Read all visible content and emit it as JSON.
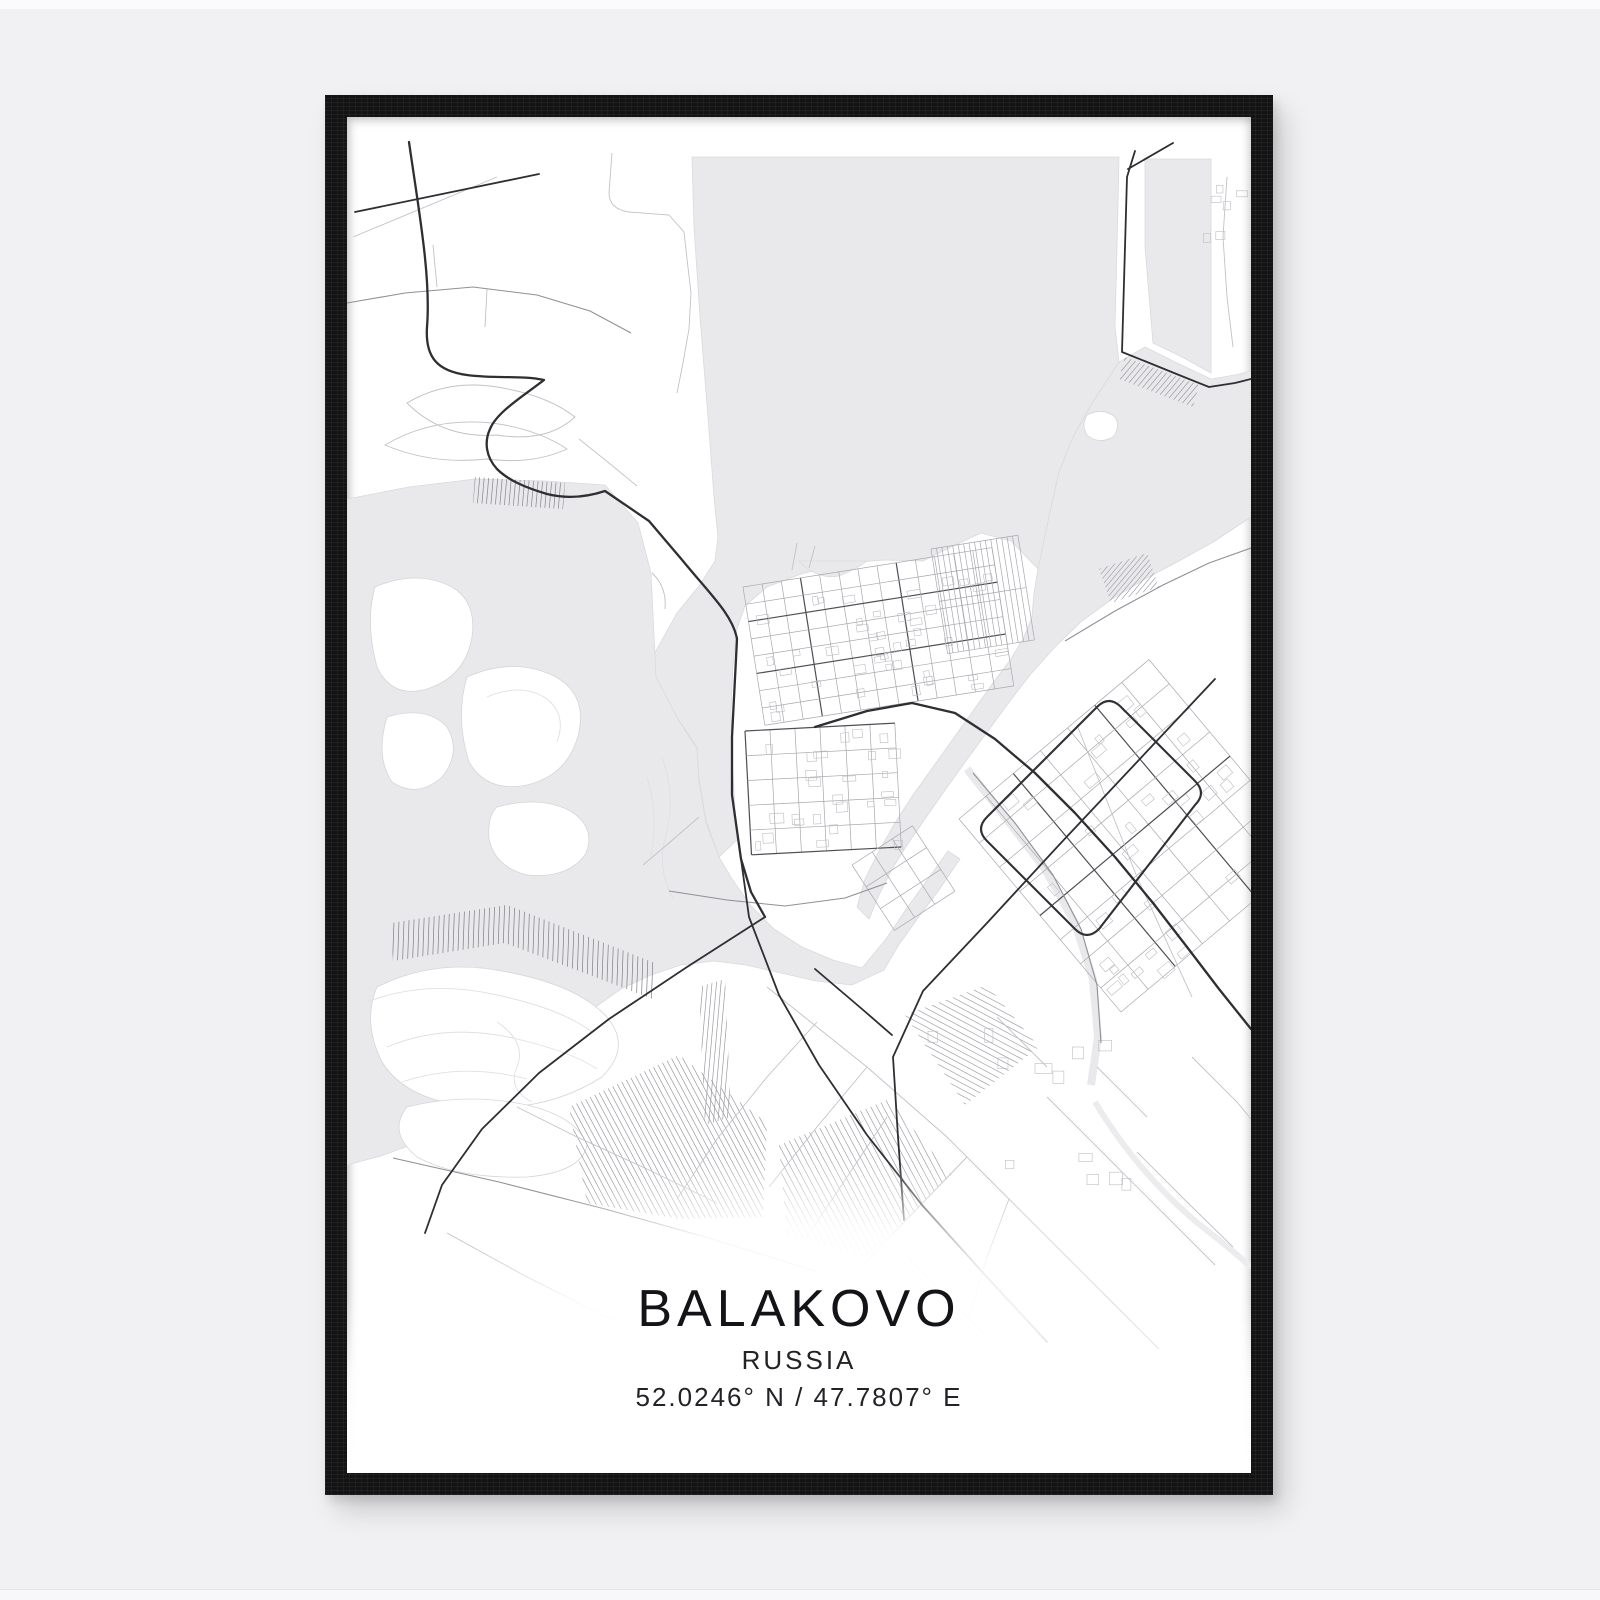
{
  "poster": {
    "title": "BALAKOVO",
    "subtitle": "RUSSIA",
    "coordinates": "52.0246° N / 47.7807° E"
  },
  "scene": {
    "wall_color": "#f1f1f3",
    "frame_color": "#131313",
    "paper_color": "#ffffff",
    "water_color": "#e9e9ec",
    "road_dark_color": "#2e2e33",
    "road_light_color": "#c2c2c7"
  },
  "map": {
    "width": 904,
    "height": 1356,
    "water": [
      "M345,40 L772,40 L770,130 L768,210 L772,245 L744,288 L726,320 L712,355 L703,395 L697,430 L691,452 L664,424 L634,416 L604,430 L576,444 L538,443 L498,446 L454,457 L420,470 L398,489 L390,512 L386,548 L384,592 L385,640 L388,692 L391,722 L372,740 L359,704 L352,662 L350,630 L331,602 L309,562 L305,541 L330,496 L352,469 L368,444 L371,420 L367,380 L361,300 L353,200 L347,110 Z",
      "M798,42 L864,42 L864,256 L835,240 L806,226 L798,130 Z",
      "M691,452 L703,395 L712,355 L726,320 L744,288 L772,245 L798,230 L830,246 L864,262 L888,258 L904,254 L904,400 L868,424 L832,444 L798,462 L765,482 L735,504 L708,530 L683,558 L660,588 L638,618 L616,648 L596,676 L578,702 L560,728 L545,752 L532,778 L522,802 L510,790 L518,762 L532,734 L548,706 L566,678 L586,650 L606,622 L626,594 L646,566 L664,542 L677,520 L685,500 L687,476 Z",
      "M0,382 L62,370 L128,362 L198,364 L258,368 L291,406 L304,456 L309,560 L331,602 L350,632 L352,664 L359,706 L372,740 L385,762 L404,789 L427,812 L455,830 L486,843 L515,851 L539,822 L560,791 L581,762 L601,734 L613,742 L592,773 L571,801 L551,829 L537,853 L505,868 L469,864 L434,856 L399,848 L367,844 L334,848 L304,858 L274,872 L247,891 L221,913 L194,939 L164,966 L134,989 L104,1009 L69,1026 L34,1039 L0,1048 Z",
      "M452,444 Q470,463 492,459 Q510,452 520,444 Z"
    ],
    "canal": {
      "d": "M620,652 L658,700 L698,752 L728,806 L746,862 L751,920 L744,968",
      "width": 8
    },
    "river_faint": {
      "d": "M748,985 Q788,1052 848,1104 Q884,1132 904,1150",
      "width": 6
    },
    "islands": [
      "M28,470 Q70,452 105,470 Q130,485 125,520 Q118,560 80,572 Q45,582 30,550 Q18,505 28,470 Z",
      "M120,560 Q165,540 205,558 Q240,575 232,615 Q222,658 180,668 Q140,676 122,645 Q108,600 120,560 Z",
      "M40,600 Q80,588 100,610 Q115,635 95,660 Q70,682 45,665 Q28,640 40,600 Z",
      "M150,690 Q195,678 225,695 Q250,712 238,738 Q220,762 180,758 Q148,750 142,722 Q140,700 150,690 Z",
      "M30,870 Q90,840 160,855 Q230,868 260,900 Q285,930 255,960 Q200,995 130,990 Q60,985 35,945 Q15,905 30,870 Z",
      "M60,990 Q120,975 180,988 Q230,1000 240,1028 Q235,1055 180,1060 Q110,1062 70,1040 Q40,1015 60,990 Z",
      "M740,298 Q756,290 768,300 Q774,310 766,320 Q752,328 740,318 Q734,308 740,298 Z"
    ],
    "contours": [
      "M20,885 Q80,862 150,878 Q215,892 245,915",
      "M40,930 Q100,905 170,922 Q225,935 250,952",
      "M55,965 Q115,945 180,962",
      "M315,640 Q330,680 318,722 Q310,752 326,782",
      "M300,660 Q312,700 304,740",
      "M150,905 Q180,925 170,950 Q160,972 185,985",
      "M140,580 Q175,565 200,582 Q220,598 210,625"
    ],
    "hatches": [
      {
        "poly": "128,360 218,366 216,392 126,386",
        "angle": 95,
        "spacing": 4.5,
        "color": "#85858b"
      },
      {
        "poly": "44,806 160,788 308,846 306,882 158,826 46,844",
        "angle": 92,
        "spacing": 5,
        "color": "#7d7d83"
      },
      {
        "poly": "222,990 332,938 420,1006 416,1100 332,1102 240,1086",
        "angle": 62,
        "spacing": 5,
        "color": "#9b9ba1"
      },
      {
        "poly": "432,1028 542,982 604,1058 520,1140 440,1118",
        "angle": 62,
        "spacing": 5.5,
        "color": "#a2a2a8"
      },
      {
        "poly": "558,898 640,868 692,930 618,988",
        "angle": 28,
        "spacing": 5.5,
        "color": "#a2a2a8"
      },
      {
        "poly": "778,240 852,268 846,290 772,262",
        "angle": -50,
        "spacing": 4.5,
        "color": "#9b9ba1"
      },
      {
        "poly": "752,452 800,436 812,470 764,486",
        "angle": -50,
        "spacing": 4,
        "color": "#a2a2a8"
      },
      {
        "poly": "352,870 378,862 384,1000 358,1008",
        "angle": 95,
        "spacing": 4.5,
        "color": "#9b9ba1"
      }
    ],
    "grids": [
      {
        "name": "old-town-upper-grid",
        "x": 396,
        "y": 470,
        "angle": -9,
        "w": 252,
        "h": 140,
        "cols": 13,
        "rows": 8,
        "majors_u": [
          2,
          5
        ],
        "majors_v": [
          3,
          8
        ]
      },
      {
        "name": "old-town-lower-grid",
        "x": 398,
        "y": 614,
        "angle": -3,
        "w": 150,
        "h": 124,
        "cols": 6,
        "rows": 5,
        "majors_u": [
          0,
          5
        ],
        "majors_v": [
          0
        ]
      },
      {
        "name": "garage-stripes",
        "x": 584,
        "y": 432,
        "angle": -9,
        "w": 88,
        "h": 106,
        "cols": 16,
        "rows": 2,
        "color": "#8e8e94"
      },
      {
        "name": "new-district-grid",
        "x": 612,
        "y": 702,
        "angle": -40,
        "w": 248,
        "h": 252,
        "cols": 7,
        "rows": 8,
        "majors_u": [
          4
        ],
        "majors_v": [
          2,
          5
        ]
      },
      {
        "name": "south-spit-grid",
        "x": 505,
        "y": 748,
        "angle": -33,
        "w": 72,
        "h": 78,
        "cols": 3,
        "rows": 3
      }
    ],
    "scatters": [
      {
        "name": "old-town-buildings-upper",
        "area": [
          402,
          480,
          -9,
          238,
          124
        ],
        "count": 44,
        "seed": 11,
        "min": 5,
        "max": 13
      },
      {
        "name": "old-town-buildings-lower",
        "area": [
          402,
          618,
          -3,
          140,
          116
        ],
        "count": 26,
        "seed": 23,
        "min": 5,
        "max": 14
      },
      {
        "name": "new-district-buildings",
        "area": [
          616,
          706,
          -40,
          236,
          240
        ],
        "count": 34,
        "seed": 37,
        "min": 6,
        "max": 15
      },
      {
        "name": "industrial-buildings",
        "area": [
          540,
          900,
          0,
          260,
          180
        ],
        "count": 12,
        "seed": 5,
        "min": 8,
        "max": 18
      },
      {
        "name": "far-bank-buildings",
        "area": [
          840,
          62,
          0,
          58,
          66
        ],
        "count": 6,
        "seed": 9,
        "min": 6,
        "max": 12
      }
    ],
    "minor_roads": [
      "M265,36 L262,76 Q262,92 282,95 L322,98 L337,115 L340,142 L344,176 L342,212 L336,246 L330,276",
      "M90,170 L86,128",
      "M140,172 L138,210",
      "M60,286 Q100,262 150,270 Q200,278 228,300 Q200,326 150,318 Q96,322 60,286 Z",
      "M38,328 Q85,300 145,306 Q190,312 220,332 Q185,348 140,342 Q85,348 38,328 Z",
      "M232,322 L262,346 L290,369",
      "M305,456 Q320,470 318,492",
      "M445,453 L450,426 M462,451 L468,429",
      "M420,870 L520,950 L600,1020 L662,1082 L722,1142",
      "M470,905 L420,960 L370,1022 L330,1082",
      "M520,950 L470,1010 L422,1070",
      "M620,1040 L562,1100 L512,1152",
      "M700,980 L760,1040 L820,1100 L868,1148",
      "M650,900 L700,950",
      "M750,950 L800,1000",
      "M790,1035 L840,1085 L886,1130",
      "M845,940 L890,985 L904,1002",
      "M720,1140 L770,1190 L812,1232",
      "M560,1140 L610,1190 L656,1236",
      "M880,60 L876,120 L880,180 L886,230",
      "M6,120 L150,60",
      "M170,990 L230,1020 L300,1052 L370,1086",
      "M540,1000 L500,1060 L460,1120",
      "M100,1116 L180,1160 L268,1204",
      "M352,700 L322,726 L296,748",
      "M730,608 L790,760 L845,880",
      "M662,1082 L640,1140 L622,1200"
    ],
    "medium_roads": [
      "M0,186 L58,176 L126,170 L190,178 L243,194 L284,216",
      "M718,524 L768,494 L816,468 L862,446 L904,431",
      "M322,774 L380,783 L438,789 L498,781 L540,766",
      "M46,1041 L152,1065 L258,1092 L362,1121 L468,1154",
      "M626,656 L668,706 L706,758 L734,812 L750,868 L754,926"
    ],
    "major_roads": [
      {
        "d": "M8,95 L192,57",
        "cls": "mj"
      },
      {
        "d": "M62,25 C72,95 84,160 80,210 C78,240 90,254 120,258 C150,262 175,258 197,263 C175,280 150,295 143,312 C137,325 139,340 150,352 C162,364 180,371 200,377 C220,382 240,380 258,374 L302,404 L336,444 C362,476 386,498 390,522 L385,620 L385,678 L394,742 L404,775 L418,800",
        "cls": "mj mj2"
      },
      {
        "d": "M418,800 L340,850 L262,902 L192,956 L135,1012 L95,1068 L78,1116",
        "cls": "mj"
      },
      {
        "d": "M394,742 L402,800 L432,878 L472,948 L520,1018 L575,1088 L638,1158 L700,1225",
        "cls": "mj"
      },
      {
        "d": "M788,34 L780,60 L778,130 L776,200 L775,235 L800,245 L832,258 L862,270 L888,266 L904,262",
        "cls": "mj"
      },
      {
        "d": "M781,52 L826,26",
        "cls": "mj"
      },
      {
        "d": "M468,610 L520,594 L565,586 L608,596 L648,622 L688,656 L728,696 L768,740 L806,786 L840,830 L872,872 L904,912",
        "cls": "mj mj2"
      },
      {
        "d": "M868,562 L790,645 L712,728 L640,806 L576,874 L546,940 L551,1020 L557,1103",
        "cls": "mj"
      },
      {
        "d": "M468,852 L515,892 L545,918",
        "cls": "mj"
      }
    ],
    "ring_road": "M640,700 L750,590 Q762,578 774,590 L848,664 Q860,676 848,688 L752,812 Q740,824 728,812 L640,724 Q628,712 640,700 Z",
    "fade": {
      "ellipse": {
        "cx": 452,
        "cy": 1222,
        "rx": 380,
        "ry": 185
      },
      "bottom_rect": {
        "y": 1180,
        "h": 176
      }
    }
  }
}
